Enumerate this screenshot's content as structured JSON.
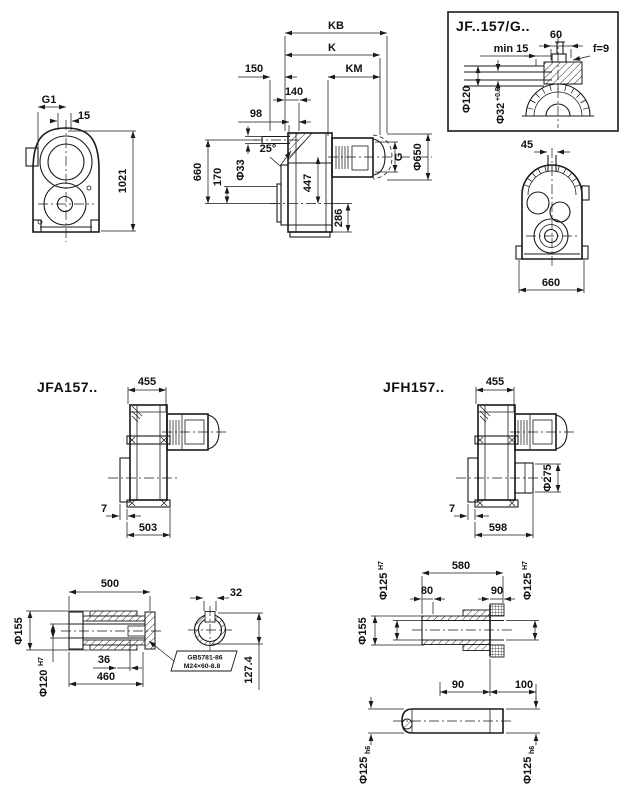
{
  "front_view": {
    "g1": "G1",
    "w15": "15",
    "h1021": "1021"
  },
  "side_view": {
    "kb": "KB",
    "k": "K",
    "km": "KM",
    "n150": "150",
    "n140": "140",
    "n98": "98",
    "n660": "660",
    "n170": "170",
    "d33": "Φ33",
    "a25": "25°",
    "n447": "447",
    "n286": "286",
    "g": "G",
    "d650": "Φ650"
  },
  "shaft_box": {
    "title": "JF..157/G..",
    "n60": "60",
    "min15": "min 15",
    "f9": "f=9",
    "d120": "Φ120",
    "d32": "Φ32",
    "d32_tol": "+0.5"
  },
  "rear_view": {
    "n45": "45",
    "n660": "660"
  },
  "jfa": {
    "title": "JFA157..",
    "n455": "455",
    "n7": "7",
    "n503": "503"
  },
  "jfh": {
    "title": "JFH157..",
    "n455": "455",
    "d275": "Φ275",
    "n7": "7",
    "n598": "598"
  },
  "hollow_shaft": {
    "n500": "500",
    "n32": "32",
    "d155": "Φ155",
    "d120": "Φ120",
    "tol_h7": "H7",
    "n36": "36",
    "n460": "460",
    "n127": "127.4",
    "callout_line1": "GB5781-86",
    "callout_line2": "M24×60-8.8"
  },
  "shrink_shaft": {
    "d125": "Φ125",
    "tol_h7": "H7",
    "tol_h6": "h6",
    "n580": "580",
    "n80": "80",
    "n90_top": "90",
    "d155": "Φ155",
    "n90_bottom": "90",
    "n100": "100"
  },
  "colors": {
    "line": "#1a1a1a",
    "background": "#ffffff"
  }
}
